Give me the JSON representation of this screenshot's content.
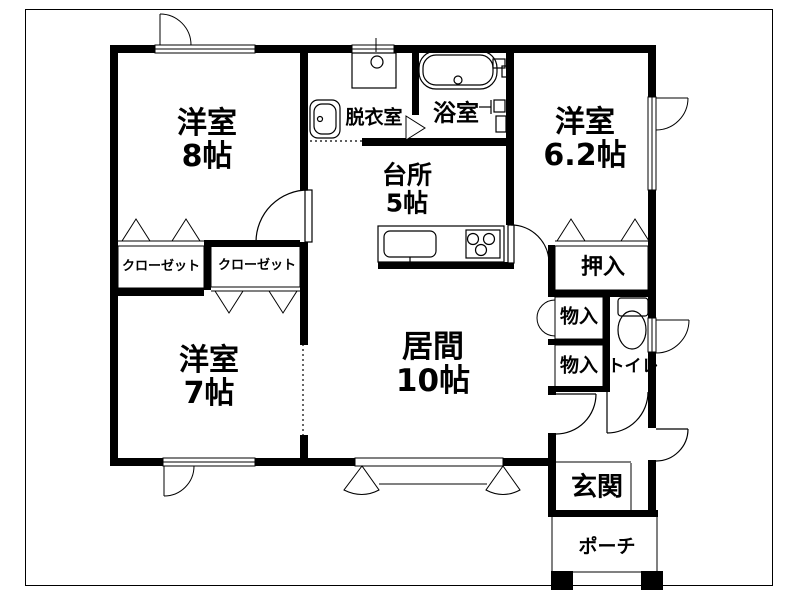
{
  "colors": {
    "wall": "#000000",
    "background": "#ffffff",
    "text": "#000000"
  },
  "labels": {
    "bedroom8": {
      "name": "洋室",
      "size": "8帖"
    },
    "bedroom7": {
      "name": "洋室",
      "size": "7帖"
    },
    "bedroom62": {
      "name": "洋室",
      "size": "6.2帖"
    },
    "kitchen": {
      "name": "台所",
      "size": "5帖"
    },
    "living": {
      "name": "居間",
      "size": "10帖"
    },
    "dressing": {
      "name": "脱衣室"
    },
    "bathroom": {
      "name": "浴室"
    },
    "closetLeft": {
      "name": "クローゼット"
    },
    "closetRight": {
      "name": "クローゼット"
    },
    "oshiire": {
      "name": "押入"
    },
    "storageUpper": {
      "name": "物入"
    },
    "storageLower": {
      "name": "物入"
    },
    "toilet": {
      "name": "トイレ"
    },
    "entrance": {
      "name": "玄関"
    },
    "porch": {
      "name": "ポーチ"
    }
  }
}
